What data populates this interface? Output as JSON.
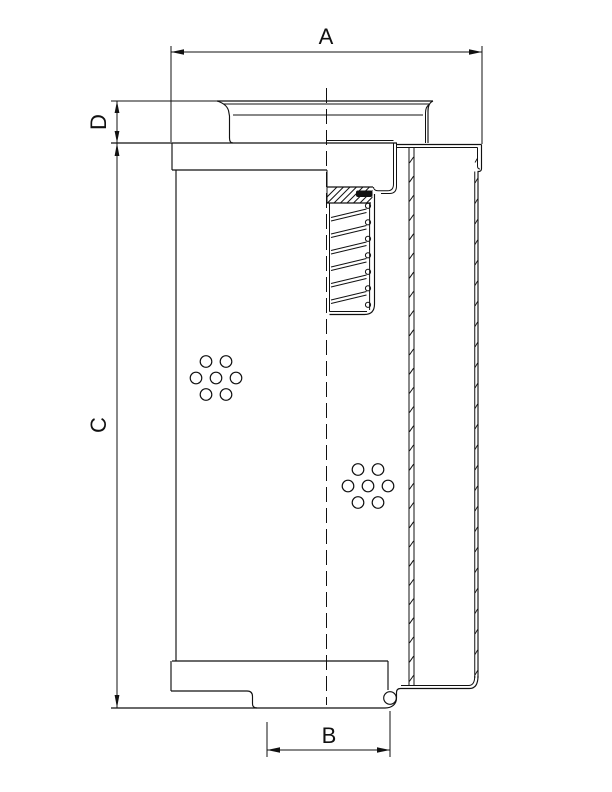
{
  "page": {
    "background_color": "#ffffff",
    "line_color": "#111111",
    "description": "Technical dimension drawing of a cylindrical filter element, half-section view with threaded port, perforation hole patterns and pleated media section"
  },
  "labels": {
    "a": "A",
    "b": "B",
    "c": "C",
    "d": "D"
  },
  "dimensions": [
    {
      "label": "A",
      "orientation": "horizontal",
      "position": "top",
      "measures": "outer-diameter"
    },
    {
      "label": "D",
      "orientation": "vertical",
      "position": "upper-left",
      "measures": "collar-height"
    },
    {
      "label": "C",
      "orientation": "vertical",
      "position": "left",
      "measures": "element-length"
    },
    {
      "label": "B",
      "orientation": "horizontal",
      "position": "bottom",
      "measures": "seal-diameter"
    }
  ]
}
